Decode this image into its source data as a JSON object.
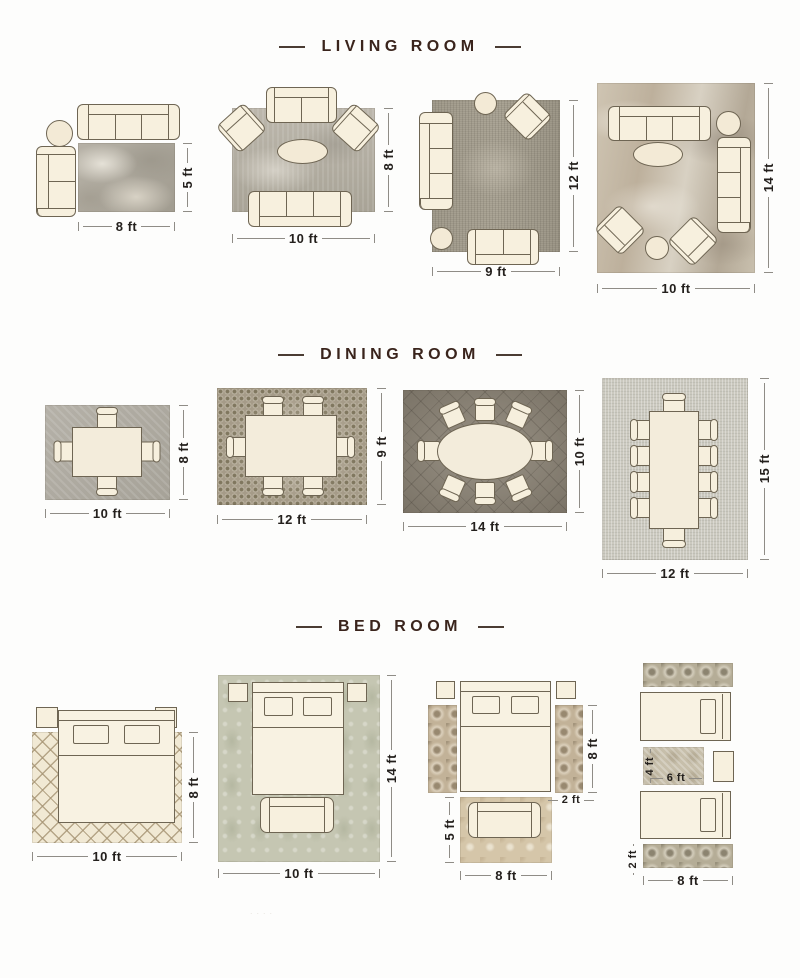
{
  "sections": [
    {
      "title": "LIVING ROOM",
      "layouts": [
        {
          "name": "sofa-chaise-rug",
          "width": "8 ft",
          "height": "5 ft"
        },
        {
          "name": "sofas-armchairs-rug",
          "width": "10 ft",
          "height": "8 ft"
        },
        {
          "name": "sofa-loveseat-rug",
          "width": "9 ft",
          "height": "12 ft"
        },
        {
          "name": "two-sofas-two-armchairs-rug",
          "width": "10 ft",
          "height": "14 ft"
        }
      ]
    },
    {
      "title": "DINING ROOM",
      "layouts": [
        {
          "name": "table-4-chairs",
          "width": "10 ft",
          "height": "8 ft"
        },
        {
          "name": "table-6-chairs",
          "width": "12 ft",
          "height": "9 ft"
        },
        {
          "name": "oval-table-8-chairs",
          "width": "14 ft",
          "height": "10 ft"
        },
        {
          "name": "table-10-chairs",
          "width": "12 ft",
          "height": "15 ft"
        }
      ]
    },
    {
      "title": "BED ROOM",
      "layouts": [
        {
          "name": "bed-on-trellis-rug",
          "width": "10 ft",
          "height": "8 ft"
        },
        {
          "name": "bed-bench-damask-rug",
          "width": "10 ft",
          "height": "14 ft"
        },
        {
          "name": "bed-side-runners-foot-rug",
          "side_height": "8 ft",
          "runner_width": "2 ft",
          "foot_height": "5 ft",
          "foot_width": "8 ft"
        },
        {
          "name": "twin-beds-runners",
          "mid_height": "4 ft",
          "mid_width": "6 ft",
          "runner_height": "2 ft",
          "width": "8 ft"
        }
      ]
    }
  ],
  "watermark": "...."
}
